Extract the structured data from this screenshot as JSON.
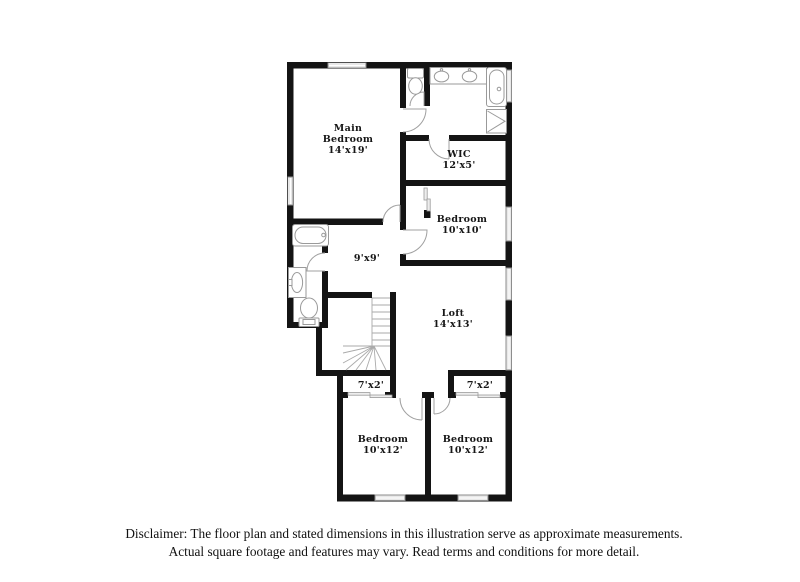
{
  "plan": {
    "title": "Second floor plan",
    "rooms": [
      {
        "id": "main-bedroom",
        "name": "Main Bedroom",
        "dims": "14'x19'",
        "lines": [
          "Main",
          "Bedroom",
          "14'x19'"
        ]
      },
      {
        "id": "wic",
        "name": "WIC",
        "dims": "12'x5'",
        "lines": [
          "WIC",
          "12'x5'"
        ]
      },
      {
        "id": "bedroom-10x10",
        "name": "Bedroom",
        "dims": "10'x10'",
        "lines": [
          "Bedroom",
          "10'x10'"
        ]
      },
      {
        "id": "hall",
        "name": "Hall",
        "dims": "9'x9'",
        "lines": [
          "9'x9'"
        ]
      },
      {
        "id": "loft",
        "name": "Loft",
        "dims": "14'x13'",
        "lines": [
          "Loft",
          "14'x13'"
        ]
      },
      {
        "id": "closet-left",
        "name": "Closet",
        "dims": "7'x2'",
        "lines": [
          "7'x2'"
        ]
      },
      {
        "id": "closet-right",
        "name": "Closet",
        "dims": "7'x2'",
        "lines": [
          "7'x2'"
        ]
      },
      {
        "id": "bedroom-left",
        "name": "Bedroom",
        "dims": "10'x12'",
        "lines": [
          "Bedroom",
          "10'x12'"
        ]
      },
      {
        "id": "bedroom-right",
        "name": "Bedroom",
        "dims": "10'x12'",
        "lines": [
          "Bedroom",
          "10'x12'"
        ]
      }
    ],
    "fixtures": [
      "toilet",
      "double-sink-vanity",
      "bathtub",
      "shower",
      "bathtub",
      "pedestal-sink",
      "toilet",
      "staircase"
    ],
    "colors": {
      "wall": "#141414",
      "fixture_line": "#9a9a9a",
      "door_line": "#a0a0a0",
      "window_fill": "#e8e8e8",
      "window_border": "#8d8d8d",
      "label_text": "#161616",
      "disclaimer_text": "#111111"
    }
  },
  "disclaimer": {
    "line1": "Disclaimer: The floor plan and stated dimensions in this illustration serve as approximate measurements.",
    "line2": "Actual square footage and features may vary. Read terms and conditions for more detail."
  }
}
